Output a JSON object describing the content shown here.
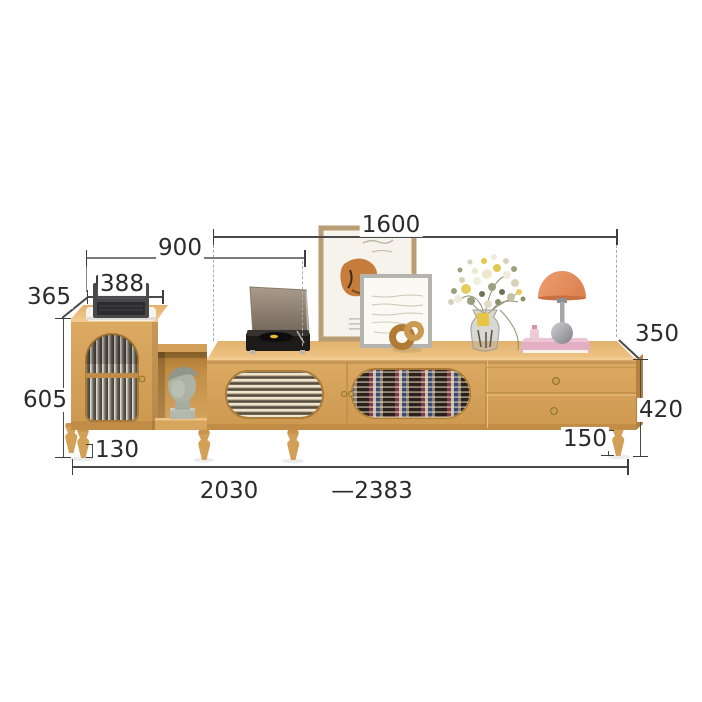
{
  "title": "tv-stand-dimension-diagram",
  "dimensions": {
    "top_width": "1600",
    "left_section_width": "900",
    "cabinet_width": "388",
    "cabinet_depth": "365",
    "cabinet_height": "605",
    "cabinet_leg_height": "130",
    "stand_depth": "350",
    "stand_height": "420",
    "stand_leg_height": "150",
    "total_width_min": "2030",
    "total_width_max": "—2383"
  },
  "colors": {
    "background": "#ffffff",
    "dim_line": "#4a4a4a",
    "dim_text": "#2b2b2b",
    "wood": "#d8a45f",
    "wood_top": "#e9bc79",
    "wood_dark": "#b5813e",
    "lamp_orange": "#e78f5f",
    "book_pink": "#e3afc2"
  }
}
